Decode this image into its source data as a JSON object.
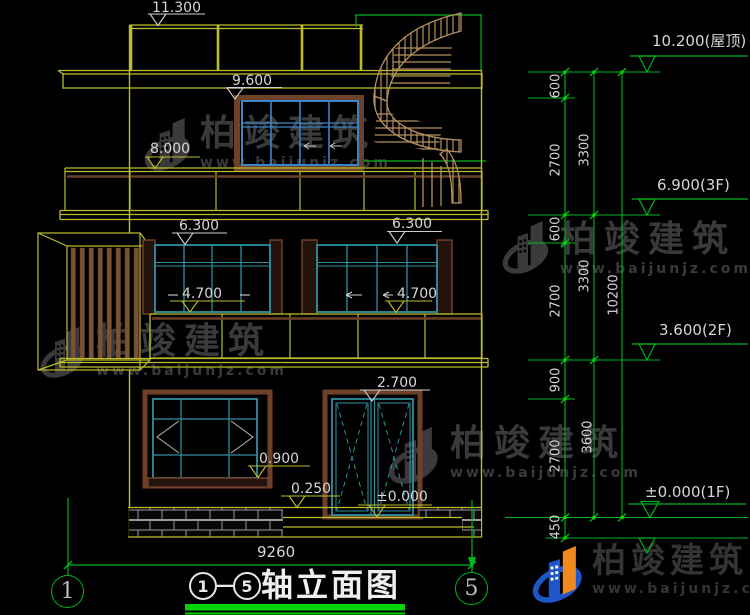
{
  "watermark": {
    "brand": "柏竣建筑",
    "site": "www.baijunjz.com"
  },
  "title_block": {
    "axis_from": "1",
    "separator": "—",
    "axis_to": "5",
    "name": "轴立面图"
  },
  "axis_bubbles": {
    "left": "1",
    "right": "5"
  },
  "overall_width": "9260",
  "marks_left": {
    "p11300": "11.300",
    "p9600": "9.600",
    "p8000": "8.000",
    "p6300a": "6.300",
    "p6300b": "6.300",
    "p4700a": "4.700",
    "p4700b": "4.700",
    "p2700": "2.700",
    "p0900": "0.900",
    "p0250": "0.250",
    "p0000": "±0.000"
  },
  "marks_right": {
    "roof": "10.200(屋顶)",
    "f3": "6.900(3F)",
    "f2": "3.600(2F)",
    "f1": "±0.000(1F)"
  },
  "dim_chains": {
    "seg_600_a": "600",
    "seg_2700_a": "2700",
    "seg_600_b": "600",
    "seg_2700_b": "2700",
    "seg_900": "900",
    "seg_2700_c": "2700",
    "seg_450": "450",
    "seg_3300_a": "3300",
    "seg_3300_b": "3300",
    "seg_3600": "3600",
    "overall": "10200"
  },
  "colors": {
    "line_yellow": "#bdbd2c",
    "dim_green": "#00b41e",
    "title_green": "#00d400",
    "frame_teal": "#2f8f9f",
    "window_blue": "#3d85c8",
    "wood_brown": "#6e4028",
    "stair_tan": "#b5905e",
    "text_gray": "#d6d6d6"
  }
}
